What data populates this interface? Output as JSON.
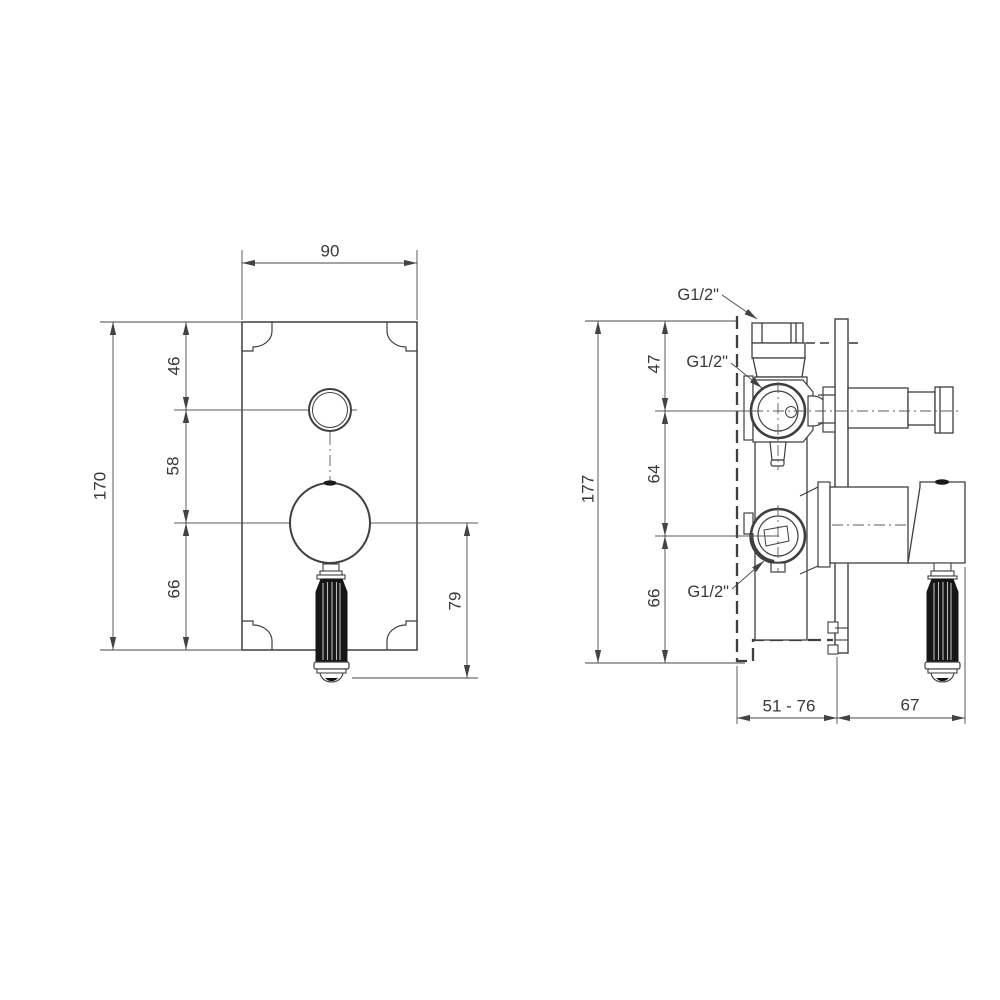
{
  "front_view": {
    "dim_width": "90",
    "dim_height_total": "170",
    "dim_top_segment": "46",
    "dim_mid_segment": "58",
    "dim_bottom_segment": "66",
    "dim_handle_drop": "79"
  },
  "side_view": {
    "dim_height_total": "177",
    "dim_top_segment": "47",
    "dim_mid_segment": "64",
    "dim_bottom_segment": "66",
    "label_thread_top": "G1/2\"",
    "label_thread_mid": "G1/2\"",
    "label_thread_bottom": "G1/2\"",
    "dim_depth_range": "51 - 76",
    "dim_handle_depth": "67"
  }
}
